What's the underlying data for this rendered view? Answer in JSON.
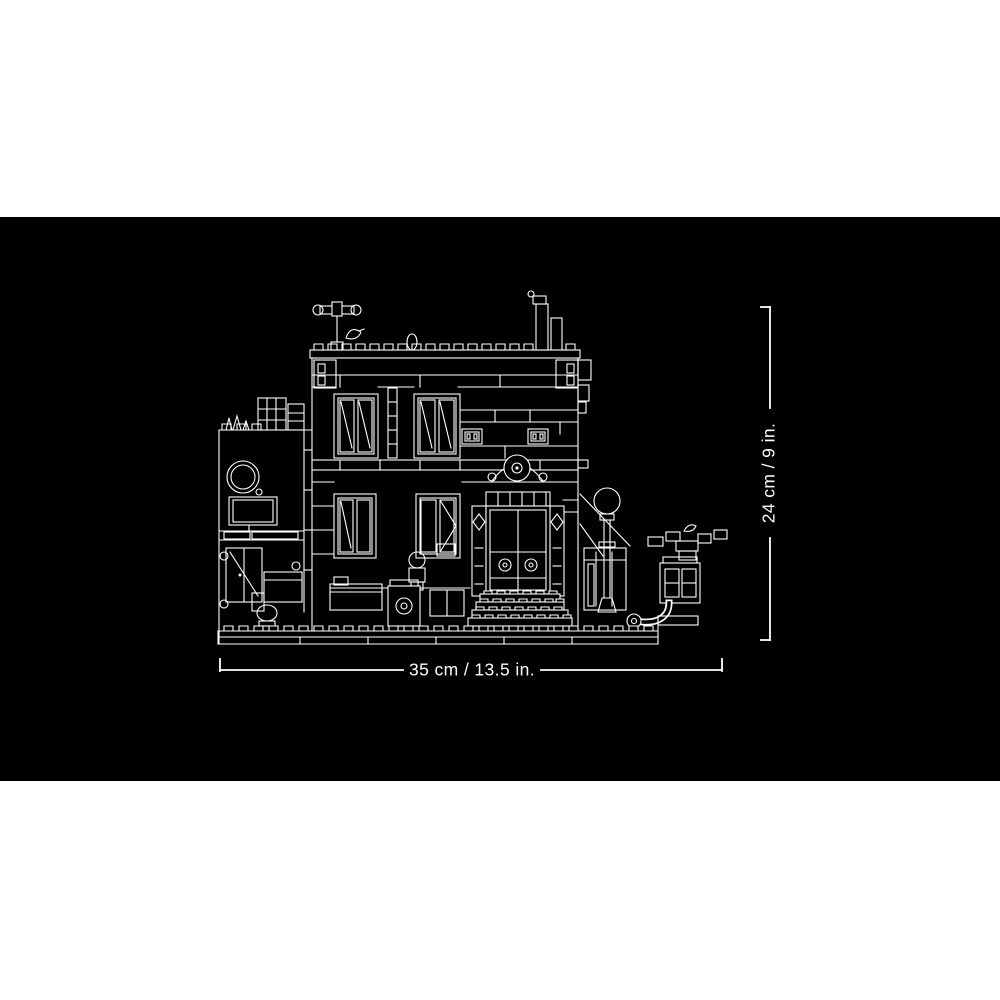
{
  "stage": {
    "background_color": "#000000",
    "artwork_color": "#ffffff",
    "artwork_name": "lego-modular-building-cross-section-line-art"
  },
  "dimension_labels": {
    "width": "35 cm / 13.5 in.",
    "height": "24 cm / 9 in."
  }
}
